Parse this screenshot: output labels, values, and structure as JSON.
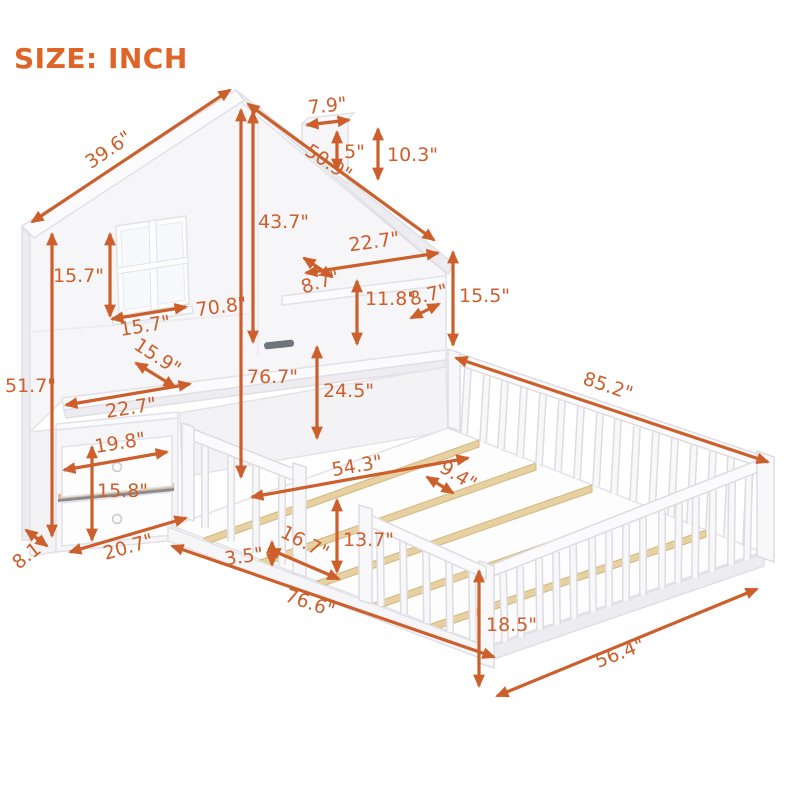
{
  "title": "SIZE: INCH",
  "colors": {
    "accent": "#cc5f2b",
    "title": "#de6428",
    "furniture": "#f6f6f9",
    "outline": "#e1e1e7",
    "wood_slat": "#e7d0a1",
    "background": "#ffffff"
  },
  "dimensions": [
    {
      "name": "left-roof-length",
      "label": "39.6\""
    },
    {
      "name": "right-roof-length",
      "label": "50.9\""
    },
    {
      "name": "chimney-width",
      "label": "7.9\""
    },
    {
      "name": "chimney-front-height",
      "label": "5\""
    },
    {
      "name": "chimney-back-height",
      "label": "10.3\""
    },
    {
      "name": "peak-to-shelf-height",
      "label": "43.7\""
    },
    {
      "name": "peak-to-floor-height",
      "label": "76.7\""
    },
    {
      "name": "window-height",
      "label": "15.7\""
    },
    {
      "name": "window-width",
      "label": "15.7\""
    },
    {
      "name": "headboard-total-width",
      "label": "70.8\""
    },
    {
      "name": "shelf-niche-width",
      "label": "22.7\""
    },
    {
      "name": "shelf-depth-left",
      "label": "8.7\""
    },
    {
      "name": "shelf-niche-height",
      "label": "11.8\""
    },
    {
      "name": "shelf-depth-right",
      "label": "8.7\""
    },
    {
      "name": "right-section-height",
      "label": "15.5\""
    },
    {
      "name": "left-wall-height",
      "label": "51.7\""
    },
    {
      "name": "desk-depth",
      "label": "15.9\""
    },
    {
      "name": "left-face-width",
      "label": "22.7\""
    },
    {
      "name": "drawer-width",
      "label": "19.8\""
    },
    {
      "name": "drawer-stack-height",
      "label": "15.8\""
    },
    {
      "name": "base-depth",
      "label": "8.1\""
    },
    {
      "name": "cabinet-width",
      "label": "20.7\""
    },
    {
      "name": "under-desk-height",
      "label": "24.5\""
    },
    {
      "name": "bed-outer-length",
      "label": "85.2\""
    },
    {
      "name": "bed-inner-width",
      "label": "54.3\""
    },
    {
      "name": "slat-spacing",
      "label": "9.4\""
    },
    {
      "name": "rail-height",
      "label": "13.7\""
    },
    {
      "name": "entrance-gap-width",
      "label": "16.7\""
    },
    {
      "name": "frame-height",
      "label": "3.5\""
    },
    {
      "name": "front-rail-length",
      "label": "76.6\""
    },
    {
      "name": "footboard-height",
      "label": "18.5\""
    },
    {
      "name": "bed-outer-width",
      "label": "56.4\""
    }
  ]
}
